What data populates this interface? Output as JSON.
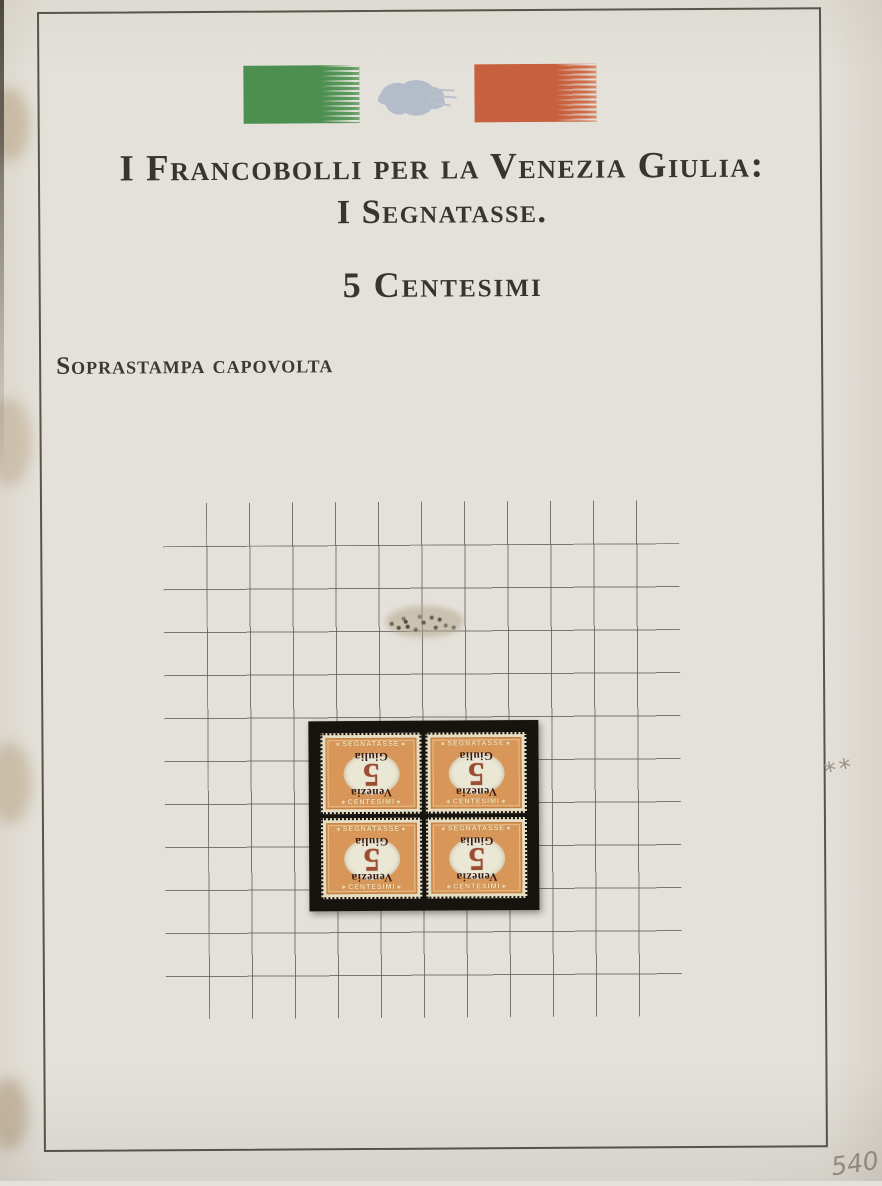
{
  "header": {
    "title_line1": "I Francobolli per la Venezia Giulia:",
    "title_line2": "I Segnatasse.",
    "denomination": "5 Centesimi",
    "variety": "Soprastampa capovolta"
  },
  "flag": {
    "green": "#4d8f50",
    "map_gray": "#b3bcc8",
    "red": "#c7603e"
  },
  "grid": {
    "cell_px": 43,
    "line_color": "#5c5c56"
  },
  "stamp_block": {
    "layout": "2x2 block of four",
    "mount_color": "#17140f",
    "stamp": {
      "top_label": "SEGNATASSE",
      "bottom_label": "CENTESIMI",
      "ornament": "∗",
      "numeral": "5",
      "overprint_line1": "Venezia",
      "overprint_line2": "Giulia",
      "overprint_inverted": true,
      "frame_color": "#d89758",
      "center_color": "#eae7d5",
      "numeral_color": "#9c4c30",
      "overprint_color": "#3a1c14"
    }
  },
  "pencil_annotations": {
    "mint_mark": "**",
    "value_note": "540"
  }
}
